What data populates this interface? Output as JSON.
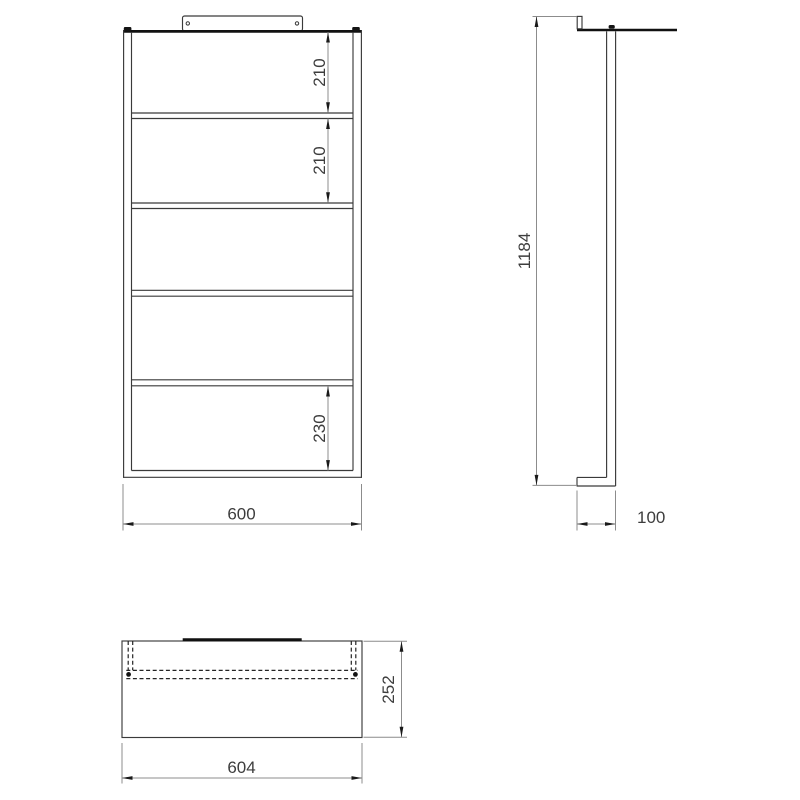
{
  "drawing": {
    "type": "technical-drawing-three-views",
    "views": {
      "front": {
        "dims": {
          "shelf_gap_1": "210",
          "shelf_gap_2": "210",
          "shelf_gap_bottom": "230",
          "width": "600"
        }
      },
      "side": {
        "dims": {
          "height": "1184",
          "depth": "100"
        }
      },
      "plan": {
        "dims": {
          "width": "604",
          "depth": "252"
        }
      }
    },
    "colors": {
      "object_line": "#3a3a3a",
      "thick_line": "#111111",
      "dimension_line": "#8c8c8c",
      "text": "#3d3d3d",
      "background": "#ffffff"
    }
  }
}
